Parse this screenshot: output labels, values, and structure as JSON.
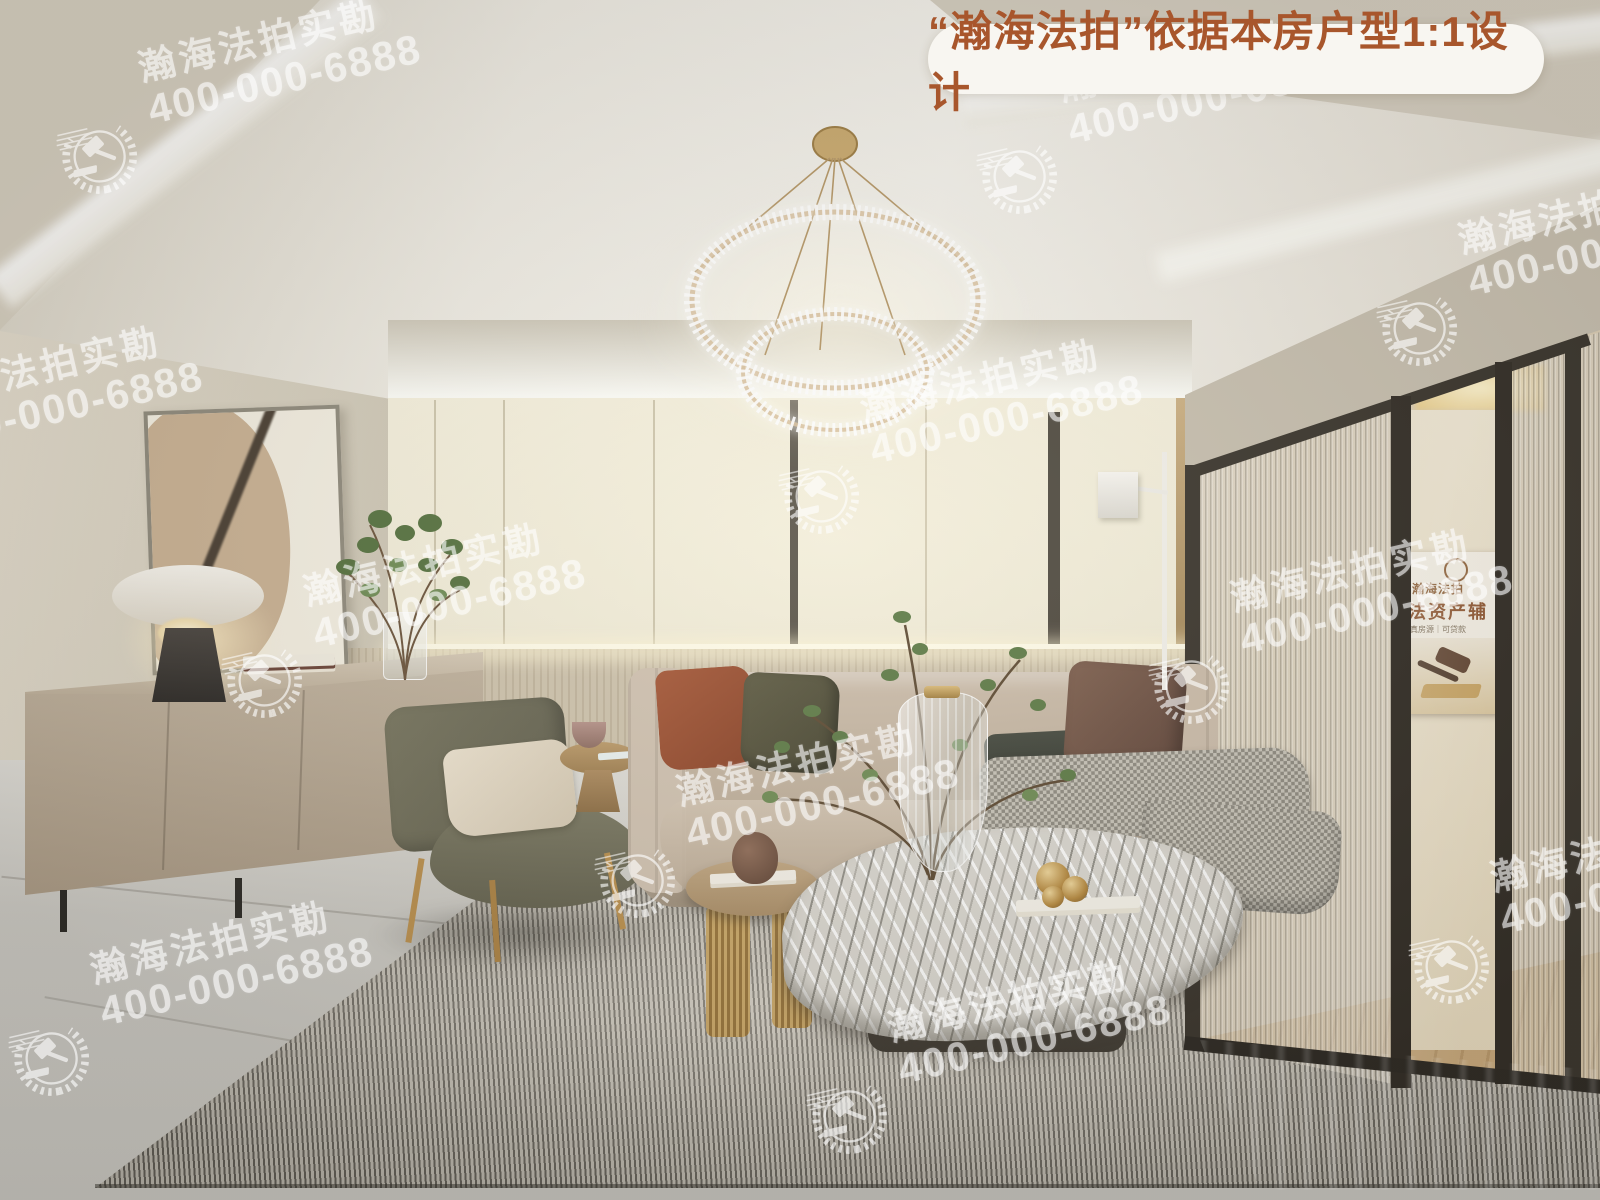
{
  "banner": {
    "text": "“瀚海法拍”依据本房户型1:1设计",
    "text_color": "#a8562c",
    "background": "#f8f6f1"
  },
  "watermark": {
    "brand": "瀚海法拍实勘",
    "phone": "400-000-6888",
    "color": "#ffffff",
    "logo_icon": "gavel-laurel-emblem",
    "count": 11
  },
  "back_room_poster": {
    "brand": "瀚海法拍",
    "headline": "法资产辅",
    "tagline": "真房源｜可贷款",
    "image": "gavel-photo"
  },
  "scene": {
    "type": "living-room-interior-render",
    "palette": {
      "ceiling": "#ece8dd",
      "back_wall": "#f3eedb",
      "left_wall": "#ddd6c6",
      "wainscot": "#cdc2ac",
      "floor": "#cac8c2",
      "rug_light": "#d3cec3",
      "rug_dark": "#615d55",
      "sofa": "#c4b5a3",
      "armchair": "#6f6d5c",
      "sideboard": "#b2a28f",
      "gold": "#c2a16c",
      "plant_green": "#5d7a46"
    }
  }
}
